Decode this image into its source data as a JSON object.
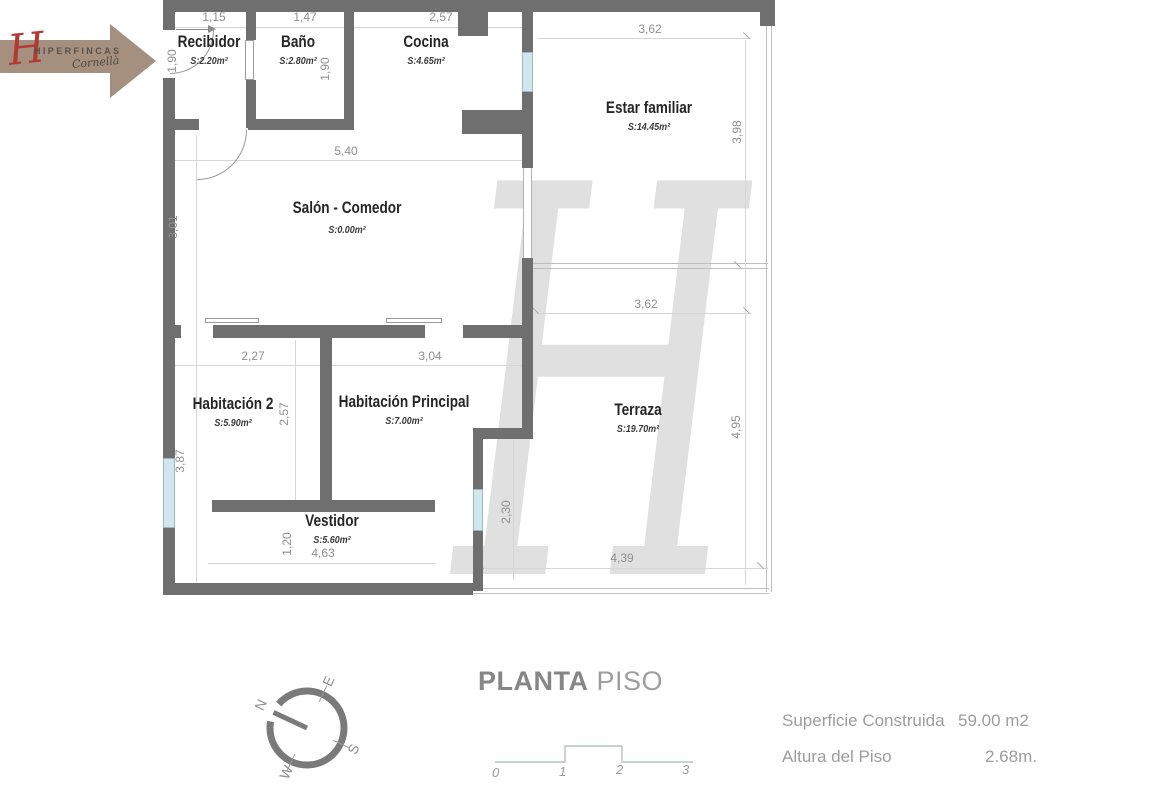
{
  "logo": {
    "monogram": "H",
    "brand": "HIPERFINCAS",
    "sub": "Cornellà"
  },
  "watermark": "H",
  "rooms": {
    "recibidor": {
      "name": "Recibidor",
      "area": "S:2.20m²"
    },
    "bano": {
      "name": "Baño",
      "area": "S:2.80m²"
    },
    "cocina": {
      "name": "Cocina",
      "area": "S:4.65m²"
    },
    "estar": {
      "name": "Estar familiar",
      "area": "S:14.45m²"
    },
    "salon": {
      "name": "Salón - Comedor",
      "area": "S:0.00m²"
    },
    "hab2": {
      "name": "Habitación 2",
      "area": "S:5.90m²"
    },
    "habp": {
      "name": "Habitación Principal",
      "area": "S:7.00m²"
    },
    "terraza": {
      "name": "Terraza",
      "area": "S:19.70m²"
    },
    "vestidor": {
      "name": "Vestidor",
      "area": "S:5.60m²"
    }
  },
  "dims": {
    "recibidor_w": "1,15",
    "bano_w": "1,47",
    "cocina_w": "2,57",
    "estar_w": "3,62",
    "recibidor_h": "1,90",
    "cocina_h": "1,90",
    "salon_w": "5,40",
    "salon_h": "3,01",
    "estar_h": "3,98",
    "terraza_w": "3,62",
    "hab2_w": "2,27",
    "habp_w": "3,04",
    "hab2_h": "2,57",
    "terraza_h": "4,95",
    "left_lower_h": "3,87",
    "terraza_left_h": "2,30",
    "vestidor_h": "1,20",
    "vestidor_w": "4,63",
    "terraza_bottom_w": "4,39"
  },
  "compass": {
    "n": "N",
    "e": "E",
    "s": "S",
    "w": "W"
  },
  "plan_title": {
    "bold": "PLANTA",
    "light": "PISO"
  },
  "scale_bar": {
    "t0": "0",
    "t1": "1",
    "t2": "2",
    "t3": "3"
  },
  "info": {
    "superficie_label": "Superficie Construida",
    "superficie_value": "59.00 m2",
    "altura_label": "Altura del Piso",
    "altura_value": "2.68m."
  },
  "colors": {
    "wall": "#6f6f6f",
    "window": "#cfe7ed",
    "logo_arrow": "#a5907f",
    "logo_monogram": "#b23a32"
  }
}
